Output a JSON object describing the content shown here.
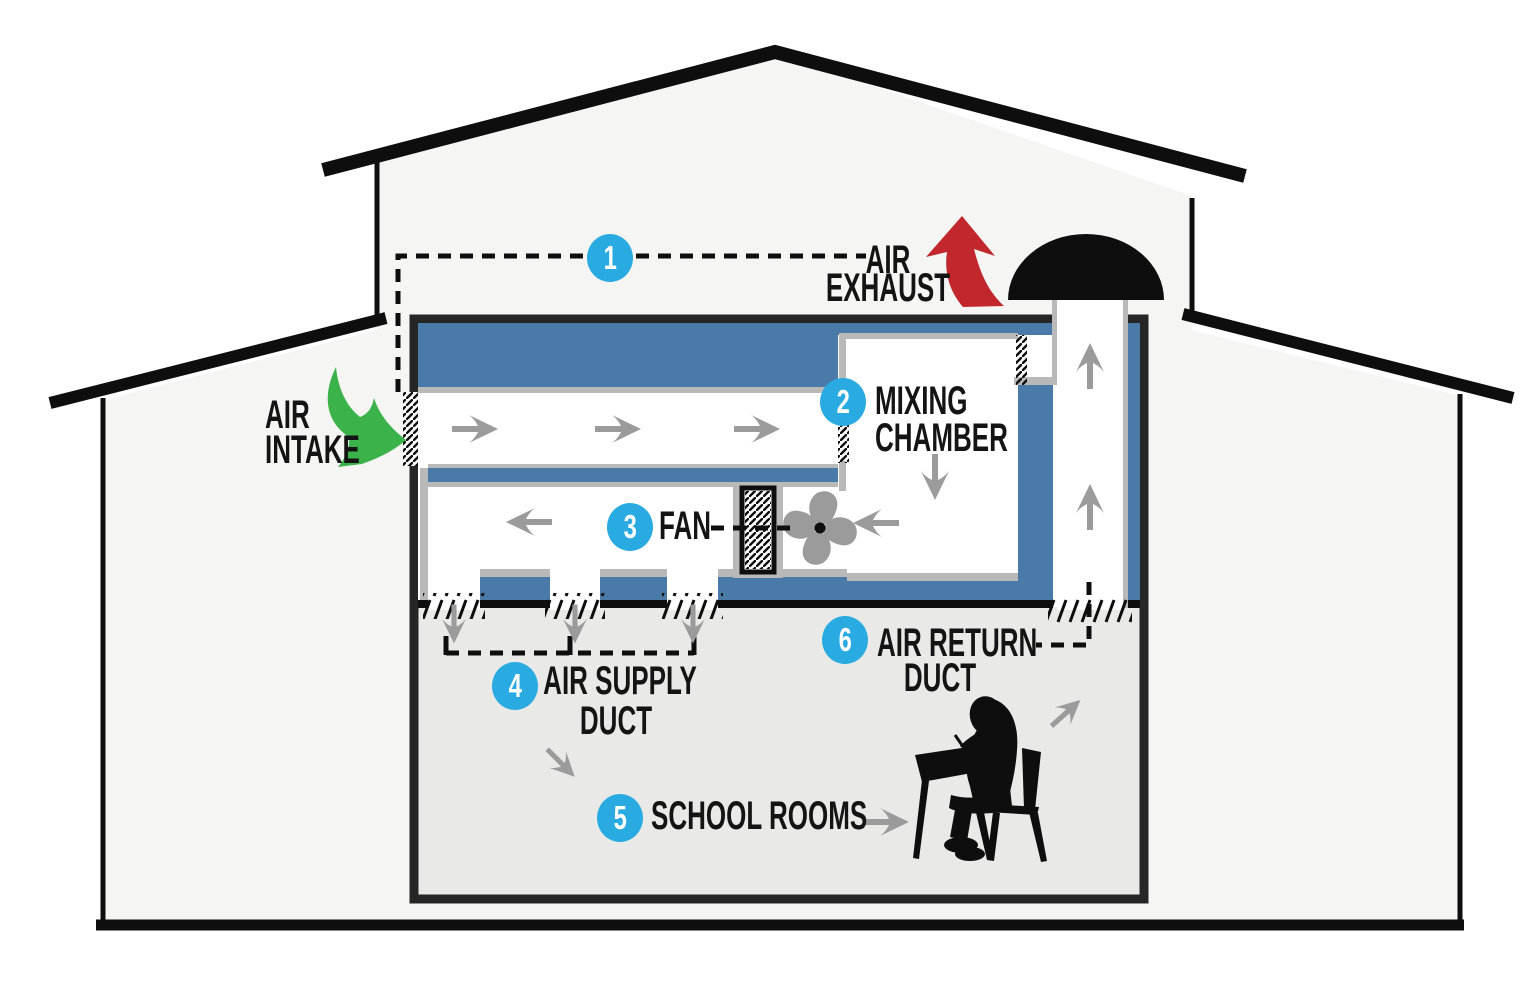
{
  "diagram_title": "School building ventilation airflow diagram",
  "palette": {
    "accent_cyan": "#29abe2",
    "duct_blue": "#4a7aa8",
    "intake_green": "#3cb24b",
    "exhaust_red": "#c1272d",
    "airflow_gray": "#9b9b9b",
    "wall_gray": "#b9b9b9",
    "building_fill": "#f5f5f3",
    "room_fill": "#e9e9e8"
  },
  "steps": {
    "step1": {
      "number": "1"
    },
    "step2": {
      "number": "2",
      "line1": "MIXING",
      "line2": "CHAMBER"
    },
    "step3": {
      "number": "3",
      "label": "FAN"
    },
    "step4": {
      "number": "4",
      "line1": "AIR SUPPLY",
      "line2": "DUCT"
    },
    "step5": {
      "number": "5",
      "label": "SCHOOL ROOMS"
    },
    "step6": {
      "number": "6",
      "line1": "AIR RETURN",
      "line2": "DUCT"
    }
  },
  "annotations": {
    "air_exhaust": {
      "line1": "AIR",
      "line2": "EXHAUST"
    },
    "air_intake": {
      "line1": "AIR",
      "line2": "INTAKE"
    }
  }
}
